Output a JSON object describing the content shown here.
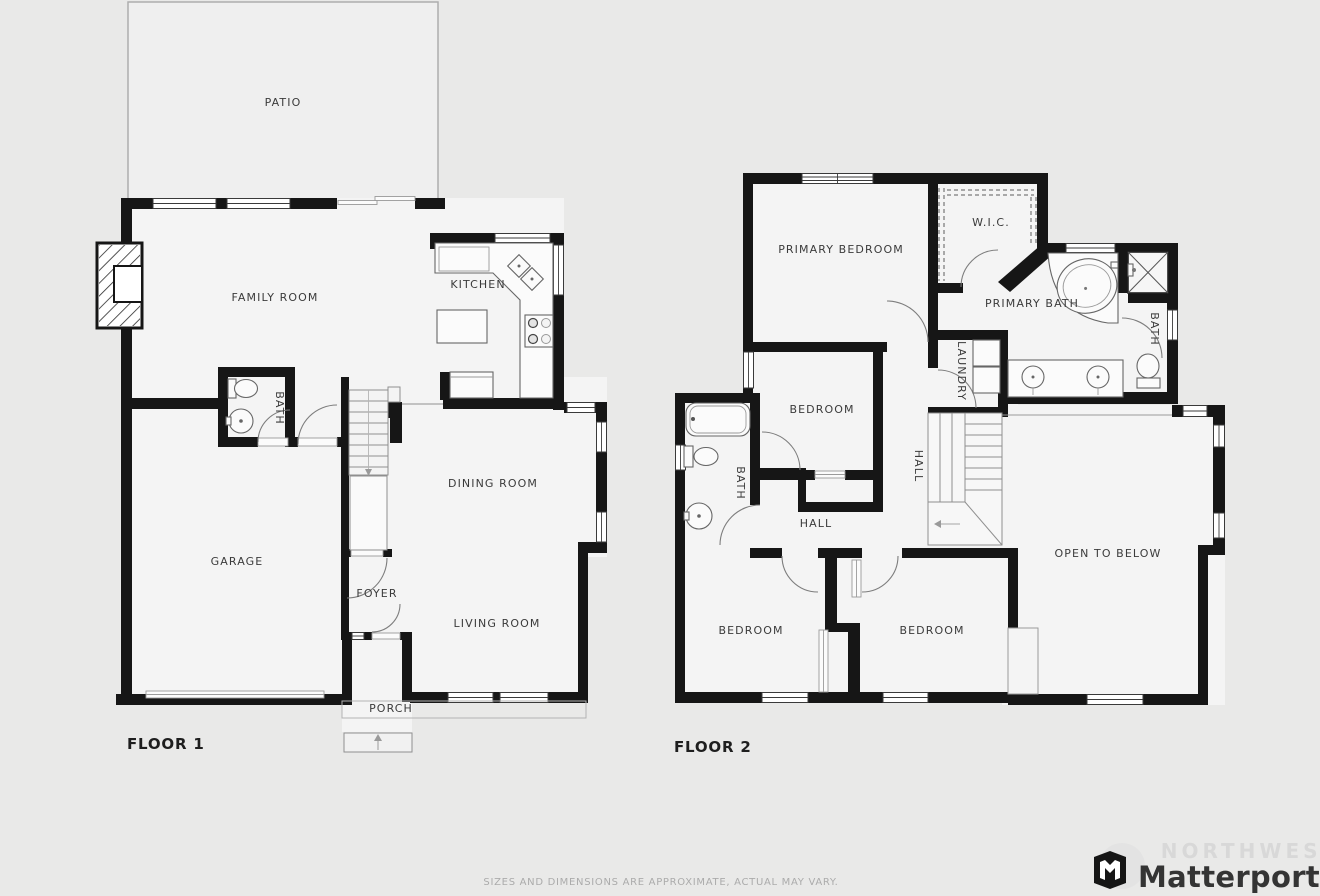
{
  "floor1": {
    "title": "FLOOR 1",
    "rooms": {
      "patio": "PATIO",
      "family_room": "FAMILY ROOM",
      "kitchen": "KITCHEN",
      "bath": "BATH",
      "garage": "GARAGE",
      "dining_room": "DINING ROOM",
      "foyer": "FOYER",
      "living_room": "LIVING ROOM",
      "porch": "PORCH"
    }
  },
  "floor2": {
    "title": "FLOOR 2",
    "rooms": {
      "primary_bedroom": "PRIMARY BEDROOM",
      "wic": "W.I.C.",
      "primary_bath": "PRIMARY BATH",
      "bath_right": "BATH",
      "laundry": "LAUNDRY",
      "bedroom_mid": "BEDROOM",
      "hall_vertical": "HALL",
      "hall": "HALL",
      "bath_left": "BATH",
      "open_to_below": "OPEN TO BELOW",
      "bedroom_left": "BEDROOM",
      "bedroom_right": "BEDROOM"
    }
  },
  "footer": {
    "disclaimer": "SIZES AND DIMENSIONS ARE APPROXIMATE, ACTUAL MAY VARY.",
    "brand": "Matterport",
    "watermark": "NORTHWEST"
  },
  "colors": {
    "wall": "#161616",
    "room_fill": "#f4f4f4",
    "background": "#e9e9e8",
    "label_text": "#3b3b3b"
  }
}
